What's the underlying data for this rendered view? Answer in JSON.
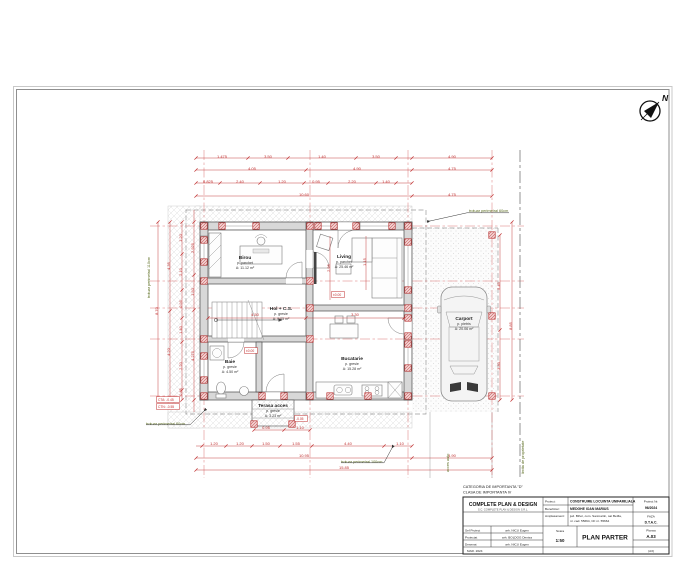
{
  "north": {
    "label": "N"
  },
  "title_block": {
    "category1": "CATEGORIA DE IMPORTANTA \"D\"",
    "category2": "CLASA DE IMPORTANTA IV",
    "firm": "COMPLETE PLAN & DESIGN",
    "firm_sub": "S.C. COMPLETE PLAN & DESIGN S.R.L.",
    "proiect_label": "Proiect:",
    "proiect": "CONSTRUIRE LOCUINTA UNIFAMILIALA",
    "beneficiar_label": "Beneficiar:",
    "beneficiar": "MEDGHE IOAN MARIUS",
    "amplasament_label": "Amplasament:",
    "amplasament1": "jud. Bihor, com. Sanmartin, sat Betfia,",
    "amplasament2": "nr. cad. 55664, CF nr. 55664",
    "proiect_nr_label": "Proiect Nr.",
    "proiect_nr": "96/2024",
    "faza_label": "FAZA",
    "faza": "D.T.A.C.",
    "plansa_label": "Plansa",
    "plansa": "A.03",
    "staff": [
      {
        "role": "Sef Proiect",
        "name": "arh. NICU Eugen"
      },
      {
        "role": "Proiectat",
        "name": "arh. BOLDOG Denisa"
      },
      {
        "role": "Desenat",
        "name": "arh. NICU Eugen"
      }
    ],
    "scara_label": "Scara",
    "scara": "1:50",
    "date": "MAR. 2024",
    "drawing_title": "PLAN PARTER",
    "format": "(A3)"
  },
  "plan": {
    "accent_red": "#c03030",
    "note_green": "#5a6b1e",
    "rooms": [
      {
        "n": "Birou",
        "f": "p. parchet",
        "a": "A: 11.12 m²",
        "x": 245,
        "y": 259
      },
      {
        "n": "Living",
        "f": "p. parchet",
        "a": "A: 25.46 m²",
        "x": 344,
        "y": 258
      },
      {
        "n": "Hol + C.S.",
        "f": "p. gresie",
        "a": "A: 9.05 m²",
        "x": 281,
        "y": 310
      },
      {
        "n": "Baie",
        "f": "p. gresie",
        "a": "A: 4.50 m²",
        "x": 230,
        "y": 363
      },
      {
        "n": "Bucatarie",
        "f": "p. gresie",
        "a": "A: 15.28 m²",
        "x": 352,
        "y": 360
      },
      {
        "n": "Terasa acces",
        "f": "p. gresie",
        "a": "A: 3.23 m²",
        "x": 273,
        "y": 407
      },
      {
        "n": "Carport",
        "f": "p. pietris",
        "a": "A: 20.06 m²",
        "x": 464,
        "y": 320
      }
    ],
    "dims": [
      {
        "t": "1.475",
        "x": 222,
        "y": 158
      },
      {
        "t": "3.50",
        "x": 268,
        "y": 158
      },
      {
        "t": "1.40",
        "x": 322,
        "y": 158
      },
      {
        "t": "3.50",
        "x": 376,
        "y": 158
      },
      {
        "t": "4.90",
        "x": 452,
        "y": 158
      },
      {
        "t": "4.05",
        "x": 252,
        "y": 170
      },
      {
        "t": "4.90",
        "x": 357,
        "y": 170
      },
      {
        "t": "4.75",
        "x": 452,
        "y": 170
      },
      {
        "t": "0.825",
        "x": 208,
        "y": 183
      },
      {
        "t": "2.40",
        "x": 240,
        "y": 183
      },
      {
        "t": "1.20",
        "x": 282,
        "y": 183
      },
      {
        "t": "0.95",
        "x": 316,
        "y": 183
      },
      {
        "t": "2.20",
        "x": 352,
        "y": 183
      },
      {
        "t": "1.40",
        "x": 386,
        "y": 183
      },
      {
        "t": "10.60",
        "x": 304,
        "y": 196
      },
      {
        "t": "4.75",
        "x": 452,
        "y": 196
      },
      {
        "t": "8.70",
        "x": 158,
        "y": 311,
        "r": -90
      },
      {
        "t": "4.35",
        "x": 170,
        "y": 266,
        "r": -90
      },
      {
        "t": "4.20",
        "x": 170,
        "y": 352,
        "r": -90
      },
      {
        "t": "1.20",
        "x": 182,
        "y": 238,
        "r": -90
      },
      {
        "t": "2.10",
        "x": 182,
        "y": 272,
        "r": -90
      },
      {
        "t": "0.95",
        "x": 182,
        "y": 304,
        "r": -90
      },
      {
        "t": "1.40",
        "x": 182,
        "y": 330,
        "r": -90
      },
      {
        "t": "2.20",
        "x": 182,
        "y": 366,
        "r": -90
      },
      {
        "t": "0.85",
        "x": 182,
        "y": 392,
        "r": -90
      },
      {
        "t": "2.925",
        "x": 194,
        "y": 248,
        "r": -90
      },
      {
        "t": "1.50",
        "x": 194,
        "y": 292,
        "r": -90
      },
      {
        "t": "4.275",
        "x": 194,
        "y": 356,
        "r": -90
      },
      {
        "t": "5.45",
        "x": 500,
        "y": 286,
        "r": -90
      },
      {
        "t": "3.30",
        "x": 500,
        "y": 366,
        "r": -90
      },
      {
        "t": "8.85",
        "x": 512,
        "y": 326,
        "r": -90
      },
      {
        "t": "0.95",
        "x": 266,
        "y": 429
      },
      {
        "t": "1.10",
        "x": 300,
        "y": 429
      },
      {
        "t": "1.20",
        "x": 214,
        "y": 445
      },
      {
        "t": "1.20",
        "x": 240,
        "y": 445
      },
      {
        "t": "1.50",
        "x": 266,
        "y": 445
      },
      {
        "t": "1.55",
        "x": 296,
        "y": 445
      },
      {
        "t": "4.40",
        "x": 348,
        "y": 445
      },
      {
        "t": "1.10",
        "x": 400,
        "y": 445
      },
      {
        "t": "10.95",
        "x": 304,
        "y": 457
      },
      {
        "t": "4.90",
        "x": 452,
        "y": 457
      },
      {
        "t": "15.85",
        "x": 344,
        "y": 469
      },
      {
        "t": "4.50",
        "x": 255,
        "y": 316
      },
      {
        "t": "3.30",
        "x": 355,
        "y": 316
      },
      {
        "t": "2.95",
        "x": 330,
        "y": 268,
        "r": -90
      },
      {
        "t": "1.15",
        "x": 366,
        "y": 262,
        "r": -90
      }
    ],
    "columns": [
      [
        204,
        226
      ],
      [
        222,
        226
      ],
      [
        256,
        226
      ],
      [
        310,
        226
      ],
      [
        318,
        226
      ],
      [
        334,
        226
      ],
      [
        356,
        226
      ],
      [
        392,
        226
      ],
      [
        408,
        226
      ],
      [
        204,
        240
      ],
      [
        204,
        262
      ],
      [
        204,
        281
      ],
      [
        204,
        339
      ],
      [
        204,
        356
      ],
      [
        204,
        380
      ],
      [
        204,
        396
      ],
      [
        262,
        396
      ],
      [
        284,
        396
      ],
      [
        310,
        396
      ],
      [
        330,
        396
      ],
      [
        368,
        396
      ],
      [
        408,
        396
      ],
      [
        408,
        242
      ],
      [
        408,
        290
      ],
      [
        408,
        308
      ],
      [
        408,
        318
      ],
      [
        408,
        336
      ],
      [
        408,
        344
      ],
      [
        408,
        368
      ],
      [
        310,
        281
      ],
      [
        310,
        308
      ],
      [
        310,
        339
      ],
      [
        492,
        235
      ],
      [
        492,
        316
      ],
      [
        492,
        396
      ],
      [
        254,
        424
      ],
      [
        292,
        424
      ]
    ],
    "notes": [
      {
        "t": "trotuar perimetral 60cm",
        "x": 469,
        "y": 212,
        "l": "430,221 467,212.8 509,212.8"
      },
      {
        "t": "trotuar perimetral 60cm",
        "x": 146,
        "y": 425,
        "l": "204,411 190,424.8 146,424.8"
      },
      {
        "t": "trotuar perimetral 110cm",
        "x": 150,
        "y": 298,
        "r": -90
      },
      {
        "t": "trotuar perimetral 100cm",
        "x": 341,
        "y": 463,
        "l": "392,448 384,462.8 341,462.8"
      },
      {
        "t": "acces auto",
        "x": 449,
        "y": 472,
        "r": -90
      },
      {
        "t": "limita de proprietate",
        "x": 524,
        "y": 474,
        "r": -90
      }
    ],
    "levels": [
      {
        "t": "CTA: -0.45",
        "x": 158,
        "y": 401
      },
      {
        "t": "CTN: -0.55",
        "x": 158,
        "y": 408
      },
      {
        "t": "±0.00",
        "x": 246,
        "y": 352
      },
      {
        "t": "±0.00",
        "x": 333,
        "y": 296
      },
      {
        "t": "-0.05",
        "x": 296,
        "y": 420
      }
    ]
  }
}
